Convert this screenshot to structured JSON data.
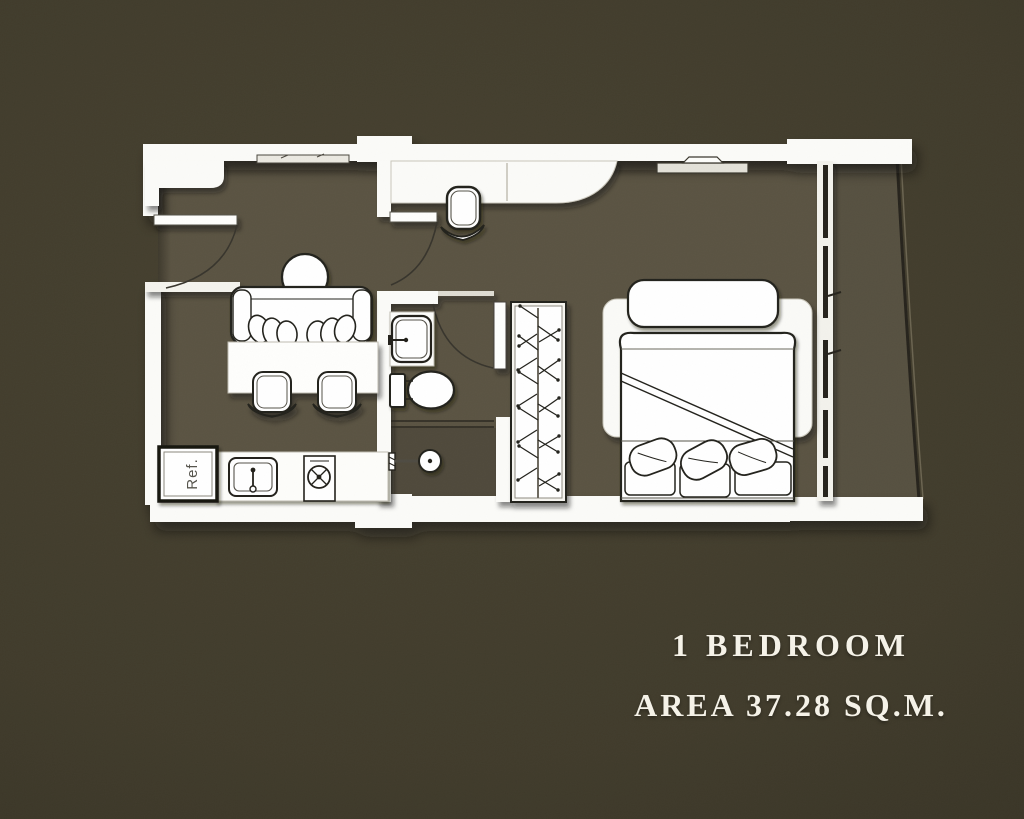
{
  "caption": {
    "line1": "1 BEDROOM",
    "line2": "AREA 37.28 SQ.M."
  },
  "plan": {
    "refrigerator_label": "Ref.",
    "colors": {
      "background": "#403b2b",
      "floor": "#5a5342",
      "balcony_floor": "#565040",
      "shower_floor": "#4e4839",
      "wall": "#fbfbf8",
      "line": "#22201a",
      "caption_text": "#f5f2e8"
    },
    "furniture_symbols": [
      "entrance-door",
      "interior-door",
      "bathroom-door",
      "sofa",
      "floor-lamp",
      "dining-table",
      "dining-chair",
      "refrigerator",
      "kitchen-sink",
      "cooktop",
      "wall-shelf",
      "desk",
      "desk-chair",
      "washbasin",
      "toilet",
      "shower",
      "wardrobe",
      "tv",
      "bed",
      "bed-bench",
      "pillow",
      "sliding-door",
      "balcony-railing"
    ]
  }
}
